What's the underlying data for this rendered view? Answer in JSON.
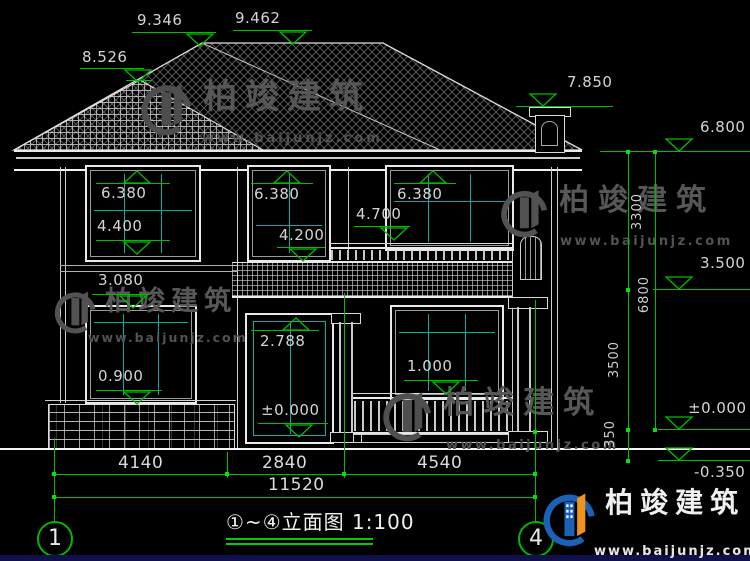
{
  "title": {
    "label": "①~④立面图 1:100"
  },
  "axis": {
    "start": "1",
    "end": "4"
  },
  "levels": {
    "ridge_left": "9.346",
    "ridge_main": "9.462",
    "hip_front": "8.526",
    "chimney_top": "7.850",
    "eave": "6.800",
    "second_floor": "3.500",
    "first_floor": "±0.000",
    "grade": "-0.350",
    "window2_head": "6.380",
    "window2_sill_left": "4.400",
    "window2_sill_mid": "4.200",
    "balcony_rail_top": "4.700",
    "window1_head": "3.080",
    "window1_sill": "0.900",
    "door_head": "2.788",
    "porch_rail_top": "1.000"
  },
  "dims": {
    "left": "4140",
    "middle": "2840",
    "right": "4540",
    "total": "11520",
    "upper_right": "3300",
    "overall_right": "6800",
    "lower_right": "3500",
    "plinth_right": "350"
  },
  "watermark": {
    "brand": "柏竣建筑",
    "site": "www.baijunjz.com"
  },
  "colors": {
    "dimension_green": "#00bd00",
    "mullion_teal": "#0fa8a8",
    "drawing_line": "#d4d4d4",
    "logo_blue": "#1b61b5",
    "logo_orange": "#f0921e"
  }
}
